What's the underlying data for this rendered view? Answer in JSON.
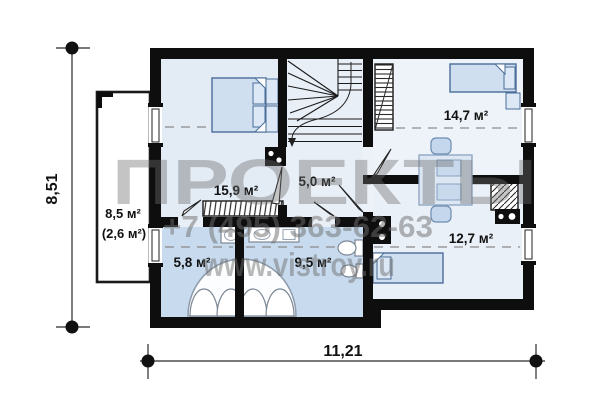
{
  "plan": {
    "type": "floor-plan",
    "rooms": [
      {
        "id": "bedroom-top-left",
        "area": "15,9 м²"
      },
      {
        "id": "stair-hall",
        "area": "5,0 м²"
      },
      {
        "id": "bedroom-top-right",
        "area": "14,7 м²"
      },
      {
        "id": "bedroom-right",
        "area": "12,7 м²"
      },
      {
        "id": "bathroom-left",
        "area": "5,8 м²"
      },
      {
        "id": "bathroom-right",
        "area": "9,5 м²"
      }
    ],
    "balcony": {
      "area": "8,5 м²",
      "area_note": "(2,6 м²)"
    },
    "dimensions": {
      "height_label": "8,51",
      "width_label": "11,21"
    }
  },
  "watermark": {
    "logo_text": "ПРОЕКТЫ",
    "phone": "+7 (495) 363-62-63",
    "website": "www.vistroy.ru"
  },
  "colors": {
    "wall": "#0e0e0e",
    "room_fill": "#e9eff7",
    "bathroom_fill": "#c8dbee",
    "furniture_fill": "#cfdff0",
    "watermark_gray": "#6e6e6e"
  }
}
